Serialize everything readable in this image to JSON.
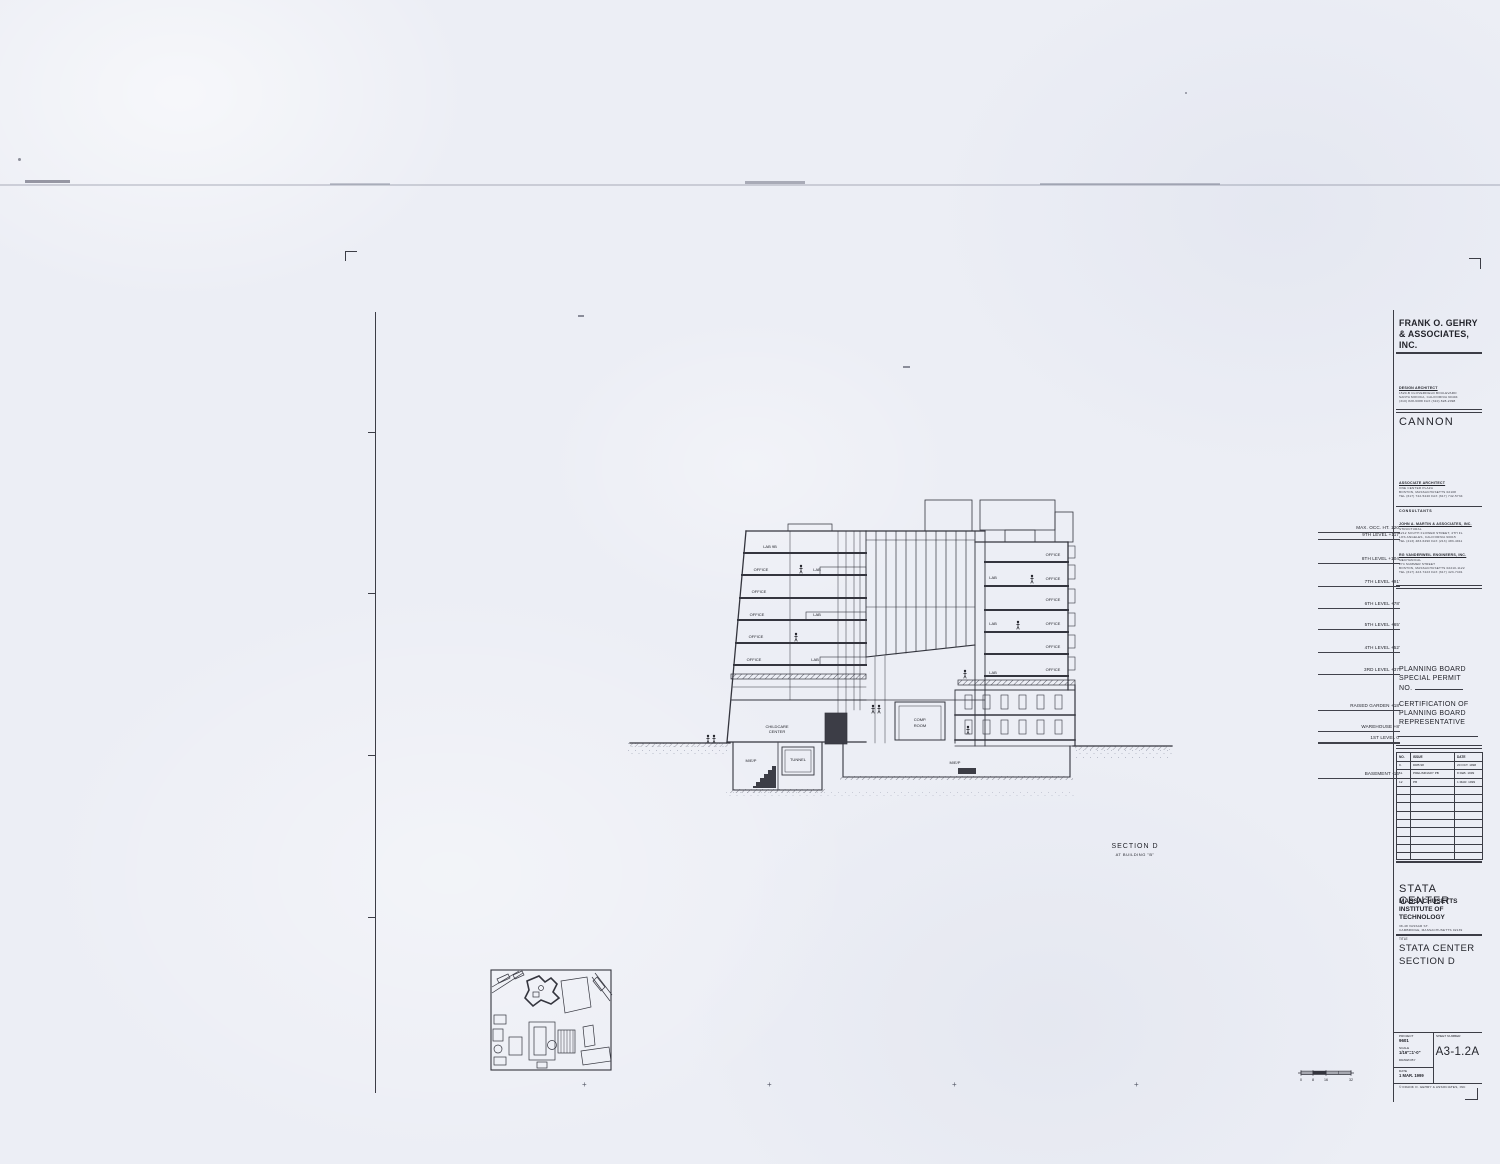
{
  "titleblock": {
    "firm_line1": "FRANK O. GEHRY",
    "firm_line2": "& ASSOCIATES, INC.",
    "design_architect": {
      "heading": "DESIGN ARCHITECT",
      "addr1": "1520-B CLOVERFIELD BOULEVARD",
      "addr2": "SANTA MONICA, CALIFORNIA 90404",
      "addr3": "(310) 828-6088   FAX (310) 828-2098"
    },
    "associate_firm": "CANNON",
    "associate_architect": {
      "heading": "ASSOCIATE ARCHITECT",
      "addr1": "ONE CENTER PLAZA",
      "addr2": "BOSTON, MASSACHUSETTS 02108",
      "addr3": "TEL (617) 742-5440   FAX (617) 742-5734"
    },
    "consultants_label": "CONSULTANTS",
    "consultant1": {
      "name": "JOHN A. MARTIN & ASSOCIATES, INC.",
      "role": "STRUCTURAL",
      "addr1": "1212 SOUTH FLOWER STREET, 4TH FL",
      "addr2": "LOS ANGELES, CALIFORNIA 90015",
      "addr3": "TEL (213) 483-6490   FAX (213) 483-4911"
    },
    "consultant2": {
      "name": "RG VANDERWEIL ENGINEERS, INC.",
      "role": "MECHANICAL",
      "addr1": "274 SUMMER STREET",
      "addr2": "BOSTON, MASSACHUSETTS 02210-1122",
      "addr3": "TEL (617) 423-7423   FAX (617) 423-7401"
    },
    "planning": {
      "line1": "PLANNING BOARD",
      "line2": "SPECIAL PERMIT",
      "line3": "NO."
    },
    "certification": {
      "line1": "CERTIFICATION OF",
      "line2": "PLANNING BOARD",
      "line3": "REPRESENTATIVE"
    },
    "revisions": {
      "col_no": "NO.",
      "col_issue": "ISSUE",
      "col_date": "DATE",
      "rows": [
        {
          "no": "9.",
          "issue": "DRB 98",
          "date": "20 OCT. 1998"
        },
        {
          "no": "11.",
          "issue": "PRELIMINARY PB",
          "date": "8 FEB. 1999"
        },
        {
          "no": "12",
          "issue": "PB",
          "date": "1 MAR. 1999"
        }
      ]
    },
    "project_name": "STATA CENTER",
    "client_line1": "MASSACHUSETTS",
    "client_line2": "INSTITUTE OF",
    "client_line3": "TECHNOLOGY",
    "client_addr1": "38-48 VASSAR ST.",
    "client_addr2": "CAMBRIDGE, MASSACHUSETTS 02139",
    "title_label": "TITLE",
    "sheet_title1": "STATA CENTER",
    "sheet_title2": "SECTION D",
    "stamp": {
      "project_label": "PROJECT",
      "project_no": "9601",
      "scale_label": "SCALE",
      "scale": "1/16\"=1'-0\"",
      "drawn_label": "DRAWN BY",
      "date_label": "DATE",
      "date": "1 MAR. 1999",
      "sheet_label": "SHEET NUMBER",
      "sheet_no": "A3-1.2A",
      "copyright": "© FRANK O. GEHRY & ASSOCIATES, INC"
    }
  },
  "section": {
    "caption_line1": "SECTION D",
    "caption_line2": "AT BUILDING \"B\"",
    "levels": [
      "MAX. OCC. HT. 120'",
      "9TH LEVEL +117'",
      "8TH LEVEL +104'",
      "7TH LEVEL +91'",
      "6TH LEVEL +78'",
      "5TH LEVEL +65'",
      "4TH LEVEL +52'",
      "3RD LEVEL +37'",
      "RAISED GARDEN +18'",
      "WAREHOUSE +8'",
      "1ST LEVEL 0'",
      "BASEMENT -16'"
    ],
    "rooms": {
      "office": "OFFICE",
      "lab": "LAB",
      "lab_top": "LAB 9B",
      "childcare1": "CHILDCARE",
      "childcare2": "CENTER",
      "comp1": "COMP.",
      "comp2": "ROOM",
      "mep": "M/E/P",
      "tunnel": "TUNNEL"
    }
  },
  "scalebar": {
    "n0": "0",
    "n1": "8",
    "n2": "16",
    "n3": "32"
  }
}
